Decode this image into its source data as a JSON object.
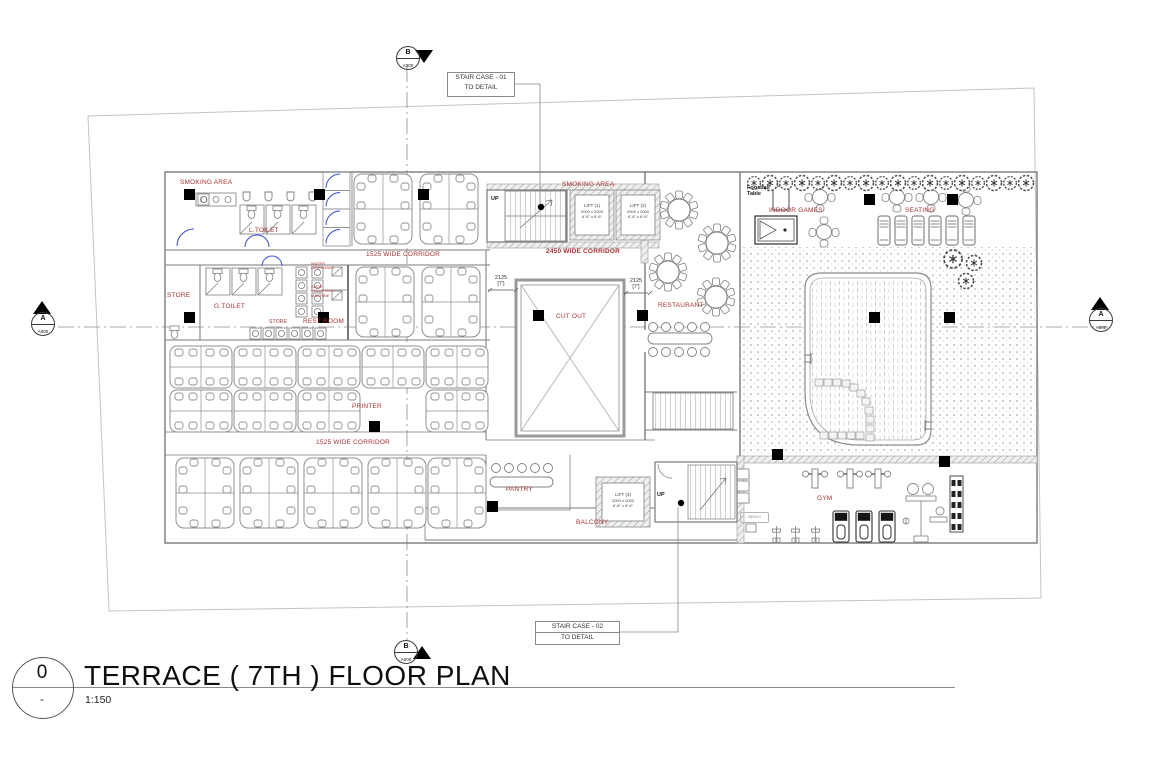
{
  "titleblock": {
    "number": "0",
    "sub": "-",
    "title": "TERRACE ( 7TH )  FLOOR PLAN",
    "scale": "1:150"
  },
  "callouts": {
    "stair1_line1": "STAIR CASE - 01",
    "stair1_line2": "TO DETAIL",
    "stair2_line1": "STAIR CASE - 02",
    "stair2_line2": "TO DETAIL"
  },
  "markers": {
    "top_letter": "B",
    "top_sheet": "A000",
    "bottom_letter": "B",
    "bottom_sheet": "A000",
    "left_letter": "A",
    "left_sheet": "A000",
    "right_letter": "A",
    "right_sheet": "A000"
  },
  "rooms": {
    "smoking_area_1": "SMOKING AREA",
    "smoking_area_2": "SMOKING AREA",
    "l_toilet": "L.TOILET",
    "g_toilet": "G.TOILET",
    "store_1": "STORE",
    "store_2": "STORE",
    "rest_room": "REST ROOM",
    "corridor_top": "1525 WIDE CORRIDOR",
    "corridor_main": "2450 WIDE CORRIDOR",
    "corridor_bottom": "1525 WIDE CORRIDOR",
    "cut_out": "CUT OUT",
    "restaurant": "RESTAURANT",
    "indoor_games": "INDOOR GAMES",
    "seating": "SEATING",
    "printer": "PRINTER",
    "pantry": "PANTRY",
    "balcony": "BALCONY",
    "gym": "GYM"
  },
  "lifts": {
    "lift1_name": "LIFT (1)",
    "lift2_name": "LIFT (2)",
    "lift3_name": "LIFT (3)",
    "dim_mm": "2000 x 2000",
    "dim_ft": "6'-6\" x 6'-6\""
  },
  "dims": {
    "cutout_left_mm": "2125",
    "cutout_left_ft": "[7']",
    "cutout_right_mm": "2125",
    "cutout_right_ft": "[7']"
  },
  "annotations": {
    "up1": "UP",
    "up2": "UP",
    "bench": "BENCH",
    "foosball": "Foosball Table",
    "water_dispenser": "WATER DISPENSER",
    "shoe_polish": "SHOE POLISHING MACHINE"
  },
  "colors": {
    "label_red": "#a83232",
    "wall_gray": "#7a7a7a",
    "furniture_gray": "#8f8f8f",
    "door_blue": "#3c50c8",
    "column_black": "#000000"
  }
}
